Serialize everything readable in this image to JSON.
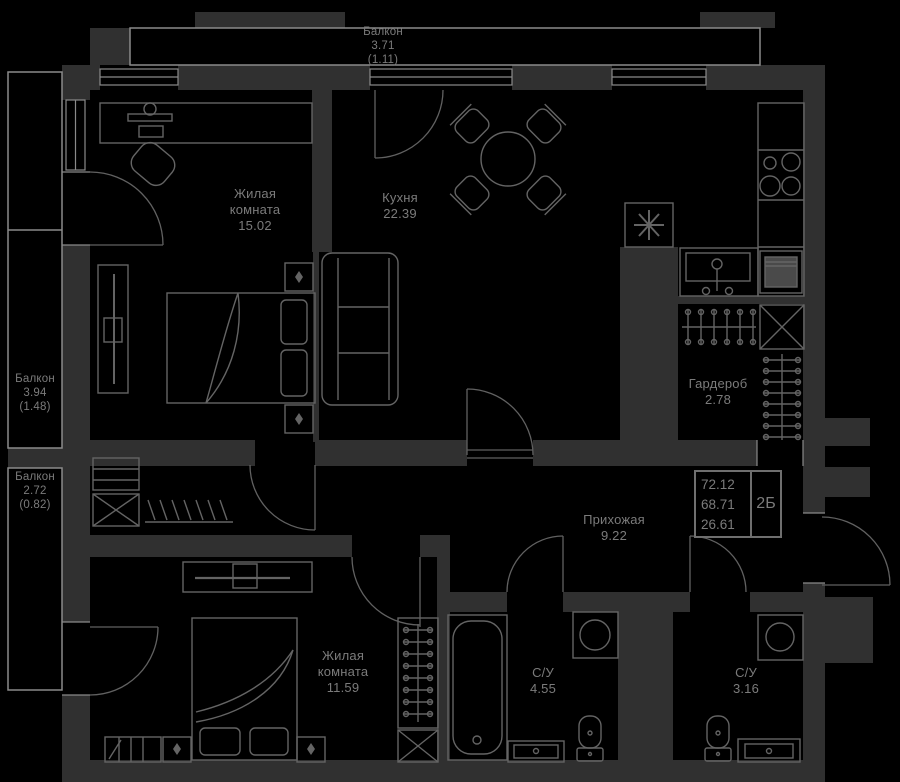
{
  "colors": {
    "background": "#000000",
    "wall": "#303030",
    "furniture_line": "#646464",
    "thin_line": "#8a8a8a",
    "text": "#7b7b7b"
  },
  "rooms": [
    {
      "id": "balcony-top",
      "name": "Балкон",
      "area": "3.71",
      "extra": "(1.11)"
    },
    {
      "id": "living-room-1",
      "name": "Жилая комната",
      "area": "15.02",
      "extra": ""
    },
    {
      "id": "kitchen",
      "name": "Кухня",
      "area": "22.39",
      "extra": ""
    },
    {
      "id": "balcony-left-1",
      "name": "Балкон",
      "area": "3.94",
      "extra": "(1.48)"
    },
    {
      "id": "balcony-left-2",
      "name": "Балкон",
      "area": "2.72",
      "extra": "(0.82)"
    },
    {
      "id": "wardrobe",
      "name": "Гардероб",
      "area": "2.78",
      "extra": ""
    },
    {
      "id": "hallway",
      "name": "Прихожая",
      "area": "9.22",
      "extra": ""
    },
    {
      "id": "living-room-2",
      "name": "Жилая комната",
      "area": "11.59",
      "extra": ""
    },
    {
      "id": "bathroom-1",
      "name": "С/У",
      "area": "4.55",
      "extra": ""
    },
    {
      "id": "bathroom-2",
      "name": "С/У",
      "area": "3.16",
      "extra": ""
    }
  ],
  "title_block": {
    "line1": "72.12",
    "line2": "68.71",
    "line3": "26.61",
    "tag": "2Б"
  }
}
